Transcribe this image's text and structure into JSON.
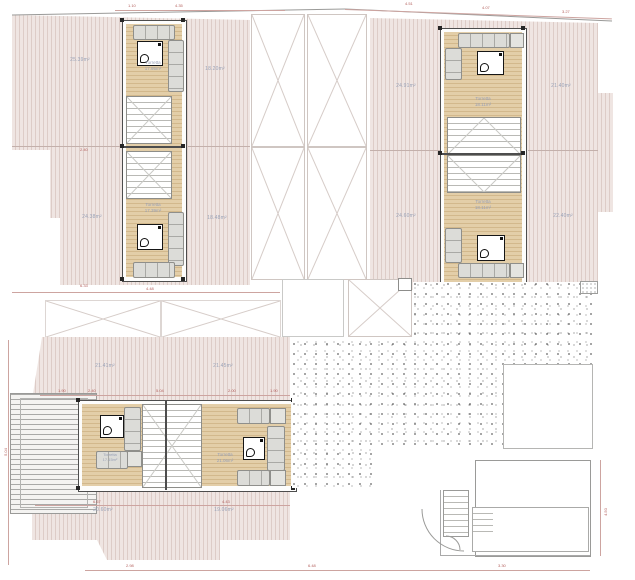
{
  "drawing": {
    "type": "architectural-roof-floor-plan",
    "units": {
      "left": {
        "terraces": {
          "top_left": "25.39m²",
          "bottom_left": "24.38m²",
          "top_right": "18.20m²",
          "bottom_right": "18.48m²"
        },
        "rooms": {
          "top": {
            "name": "Torretta",
            "area": "17.95m²"
          },
          "bottom": {
            "name": "Torretta",
            "area": "17.39m²"
          }
        }
      },
      "right": {
        "terraces": {
          "top_left": "24.91m²",
          "bottom_left": "24.60m²",
          "top_right": "21.40m²",
          "bottom_right": "22.40m²"
        },
        "rooms": {
          "top": {
            "name": "Torretta",
            "area": "18.11m²"
          },
          "bottom": {
            "name": "Torretta",
            "area": "18.11m²"
          }
        }
      },
      "bottom": {
        "terraces": {
          "top_left": "21.41m²",
          "top_right": "21.45m²",
          "bottom_left": "20.60m²",
          "bottom_right": "19.06m²"
        },
        "rooms": {
          "left": {
            "name": "Torretta",
            "area": "17.15m²"
          },
          "right": {
            "name": "Torretta",
            "area": "21.06m²"
          }
        }
      }
    },
    "dimensions": [
      {
        "text": "4.51"
      },
      {
        "text": "4.07"
      },
      {
        "text": "3.27"
      },
      {
        "text": "4.35"
      },
      {
        "text": "1.10"
      },
      {
        "text": "2.40"
      },
      {
        "text": "4.48"
      },
      {
        "text": "1.90"
      },
      {
        "text": "2.40"
      },
      {
        "text": "5.04"
      },
      {
        "text": "2.00"
      },
      {
        "text": "1.90"
      },
      {
        "text": "6.67"
      },
      {
        "text": "4.43"
      },
      {
        "text": "2.98"
      },
      {
        "text": "6.48"
      },
      {
        "text": "3.30"
      },
      {
        "text": "4.50"
      },
      {
        "text": "5.04"
      },
      {
        "text": "6.33"
      }
    ],
    "colors": {
      "terrace_hatch": "#e7d8d4",
      "wood_floor": "#dbc29a",
      "dimension_red": "#b35f5c",
      "label_blue_gray": "#9aa3b8"
    }
  }
}
